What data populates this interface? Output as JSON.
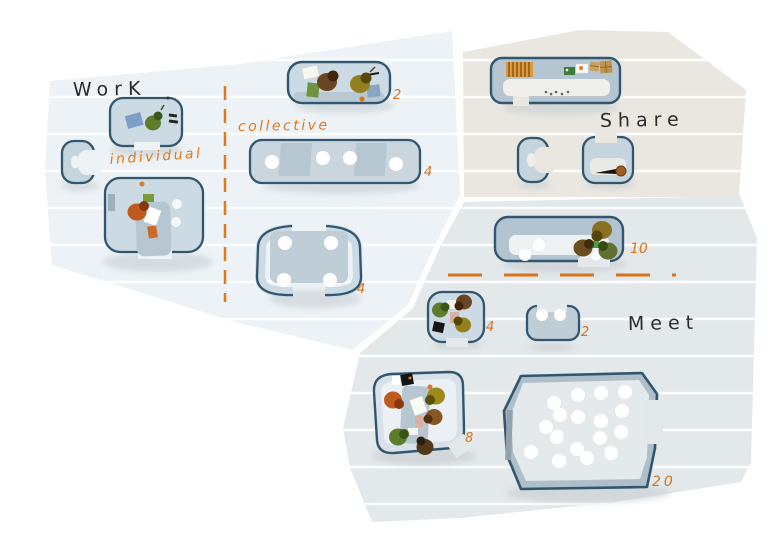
{
  "illustration": {
    "zones": {
      "work": {
        "label": "WorK"
      },
      "individual": {
        "label": "individual"
      },
      "collective": {
        "label": "collective"
      },
      "share": {
        "label": "Share"
      },
      "meet": {
        "label": "Meet"
      }
    },
    "capacities": {
      "collective_booth": "2",
      "collective_bench": "4",
      "collective_table": "4",
      "standing_table": "10",
      "huddle_pod": "4",
      "duo_bench": "2",
      "meeting_room": "8",
      "presentation_room": "20"
    },
    "colors": {
      "background": "#ffffff",
      "zone_work_fill": "#ecf2f5",
      "zone_share_fill": "#e9e7e0",
      "zone_meet_fill": "#e3e8ea",
      "furniture_outline": "#31566f",
      "furniture_fill_light": "#ccdae3",
      "furniture_fill_dark": "#b2c4d0",
      "accent_orange": "#d9731a",
      "label_black": "#2c2c2c"
    }
  }
}
